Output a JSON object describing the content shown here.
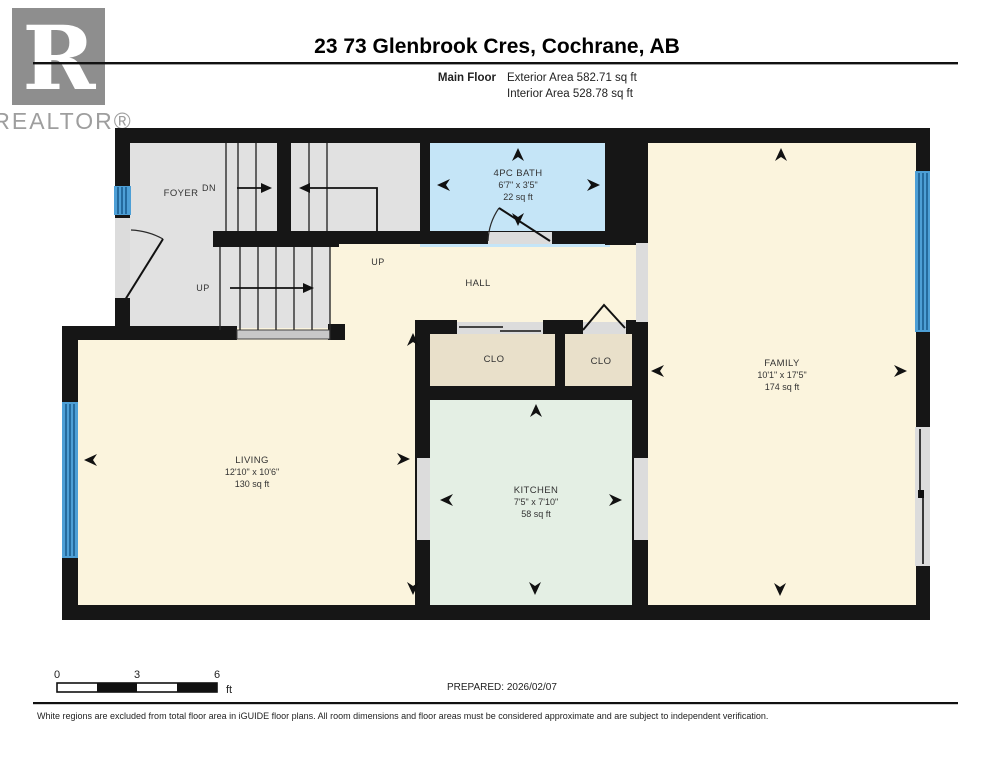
{
  "header": {
    "logo": {
      "letter": "R",
      "brand": "REALTOR®"
    },
    "title": "23 73 Glenbrook Cres, Cochrane, AB",
    "floor_label": "Main Floor",
    "exterior_area": "Exterior Area 582.71 sq ft",
    "interior_area": "Interior Area 528.78 sq ft"
  },
  "rooms": {
    "foyer": {
      "label": "FOYER"
    },
    "hall": {
      "label": "HALL"
    },
    "bath": {
      "label": "4PC BATH",
      "dims": "6'7\" x 3'5\"",
      "area": "22 sq ft"
    },
    "living": {
      "label": "LIVING",
      "dims": "12'10\" x 10'6\"",
      "area": "130 sq ft"
    },
    "kitchen": {
      "label": "KITCHEN",
      "dims": "7'5\" x 7'10\"",
      "area": "58 sq ft"
    },
    "family": {
      "label": "FAMILY",
      "dims": "10'1\" x 17'5\"",
      "area": "174 sq ft"
    },
    "closet_left": {
      "label": "CLO"
    },
    "closet_right": {
      "label": "CLO"
    }
  },
  "stairs": {
    "dn": "DN",
    "up_lower": "UP",
    "up_hall": "UP"
  },
  "scale_bar": {
    "tick_0": "0",
    "tick_3": "3",
    "tick_6": "6",
    "unit": "ft"
  },
  "prepared": "PREPARED: 2026/02/07",
  "footer": "White regions are excluded from total floor area in iGUIDE floor plans. All room dimensions and floor areas must be considered approximate and are subject to independent verification.",
  "colors": {
    "wall": "#161616",
    "stair_gray": "#e1e1e1",
    "cream": "#fbf4dd",
    "bath_blue": "#c5e5f7",
    "kitchen_mint": "#e4efe4",
    "closet_tan": "#e9e0ca",
    "window_blue": "#4d9fd6",
    "opening_gray": "#dcdcdc",
    "landing_gray": "#c8c8c8"
  }
}
